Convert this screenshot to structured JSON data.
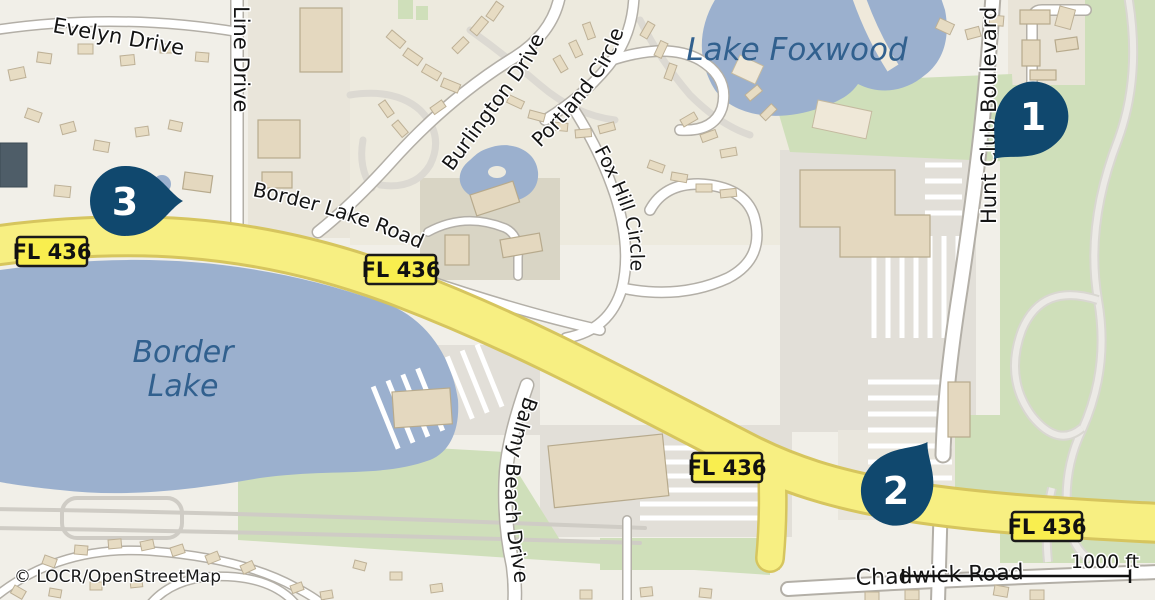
{
  "attribution": {
    "text": "© LOCR/OpenStreetMap"
  },
  "scale": {
    "label": "1000 ft"
  },
  "shield": {
    "label": "FL 436"
  },
  "markers": {
    "m1": "1",
    "m2": "2",
    "m3": "3"
  },
  "labels": {
    "streets": {
      "evelyn": "Evelyn Drive",
      "line": "Line Drive",
      "burlington": "Burlington Drive",
      "portland": "Portland Circle",
      "foxhill": "Fox Hill Circle",
      "borderlakeroad": "Border Lake Road",
      "huntclub": "Hunt Club Boulevard",
      "balmy": "Balmy Beach Drive",
      "chadwick": "Chadwick Road"
    },
    "lakes": {
      "foxwood": "Lake Foxwood",
      "border1": "Border",
      "border2": "Lake"
    }
  },
  "colors": {
    "pin": "#10486e",
    "shield": "#f9ee4e",
    "highway": "#f7ef82",
    "water": "#9bb0ce",
    "park": "#cfdfba",
    "land": "#f1efe8",
    "street_label": "#141414",
    "lake_label": "#31608e"
  }
}
